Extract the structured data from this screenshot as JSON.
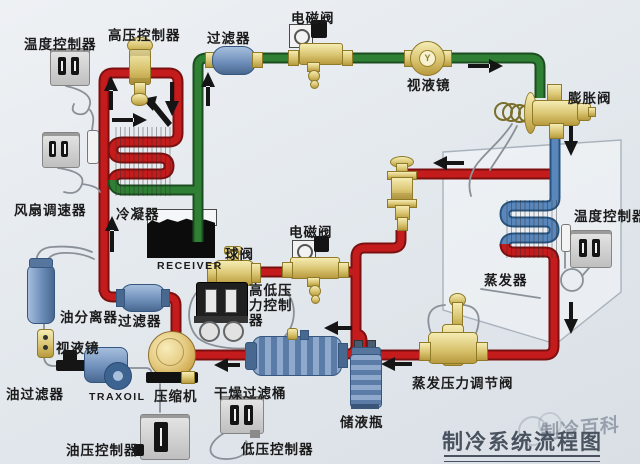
{
  "title": {
    "text": "制冷系统流程图",
    "watermark": "制冷百科"
  },
  "labels": {
    "temp_ctrl_left": "温度控制器",
    "hp_ctrl": "高压控制器",
    "filter_top": "过滤器",
    "solenoid_top": "电磁阀",
    "sight_glass_top": "视液镜",
    "expansion_valve": "膨胀阀",
    "fan_ctrl": "风扇调速器",
    "condenser": "冷凝器",
    "receiver": "RECEIVER",
    "ball_valve": "球阀",
    "solenoid_mid": "电磁阀",
    "hlp1": "高低压",
    "hlp2": "力控制",
    "hlp3": "器",
    "temp_ctrl_right": "温度控制器",
    "evaporator": "蒸发器",
    "oil_separator": "油分离器",
    "filter_mid": "过滤器",
    "sight_glass_left": "视液镜",
    "oil_filter": "油过滤器",
    "traxoil": "TRAXOIL",
    "compressor": "压缩机",
    "drying_filter": "干燥过滤桶",
    "liquid_bottle": "储液瓶",
    "epr_valve": "蒸发压力调节阀",
    "lp_ctrl": "低压控制器",
    "oil_pressure_ctrl": "油压控制器"
  },
  "colors": {
    "pipe_hot": "#c41c1c",
    "pipe_liquid": "#2f8034",
    "pipe_suction": "#5a87bb",
    "brass": "#d9c470",
    "component_blue": "#6b8cb8",
    "background": "#e8edf1"
  }
}
